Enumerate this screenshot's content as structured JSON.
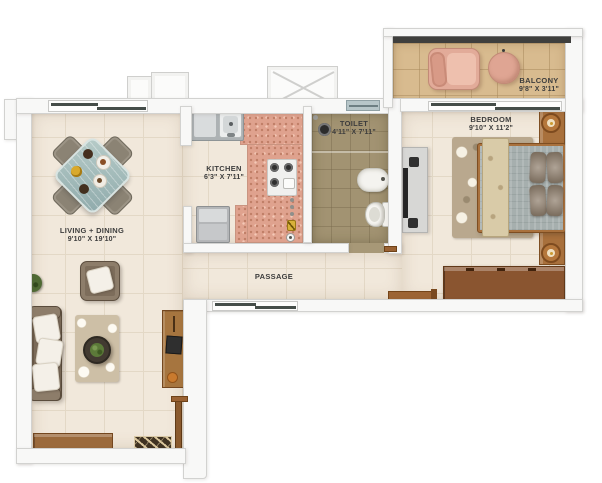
{
  "rooms": {
    "living": {
      "name": "LIVING + DINING",
      "dims": "9'10\" X 19'10\""
    },
    "kitchen": {
      "name": "KITCHEN",
      "dims": "6'3\" X 7'11\""
    },
    "toilet": {
      "name": "TOILET",
      "dims": "4'11\" X 7'11\""
    },
    "bedroom": {
      "name": "BEDROOM",
      "dims": "9'10\" X 11'2\""
    },
    "balcony": {
      "name": "BALCONY",
      "dims": "9'8\" X 3'11\""
    },
    "passage": {
      "name": "PASSAGE"
    }
  },
  "colors": {
    "floor_beige": "#f1e8db",
    "counter_pink": "#dfa28e",
    "toilet_olive": "#a29372",
    "balcony_tan": "#d8bb8f",
    "wall_white": "#f8f8f7",
    "wood_brown": "#9b6a3c",
    "wardrobe_brown": "#8a5530",
    "sofa_brown": "#7b6b59",
    "bed_gray": "#a6afae",
    "balcony_pink": "#e2ab99",
    "railing_dark": "#3f3f3d",
    "glass_teal": "#a9c1be",
    "label_gray": "#3d3d3d"
  }
}
